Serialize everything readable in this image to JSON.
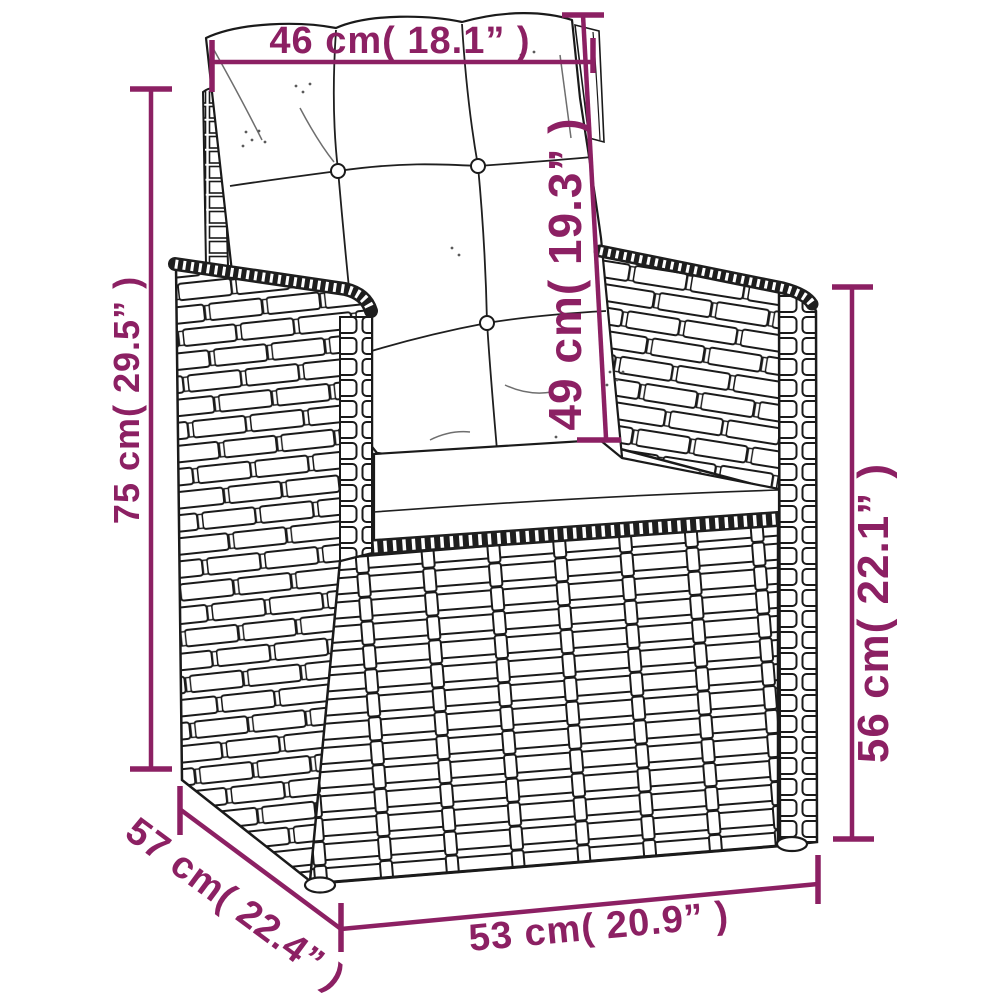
{
  "diagram": {
    "kind": "product-dimension-diagram",
    "subject": "rattan wicker armchair with back and seat cushions",
    "accent_color": "#8C2063",
    "line_color": "#1a1a1a",
    "background_color": "#ffffff"
  },
  "dimensions": {
    "top_width": {
      "label": "46 cm( 18.1” )",
      "cm": 46,
      "inches": 18.1,
      "measures": "back cushion width"
    },
    "back_height": {
      "label": "49 cm( 19.3” )",
      "cm": 49,
      "inches": 19.3,
      "measures": "back cushion height"
    },
    "total_height": {
      "label": "75 cm( 29.5” )",
      "cm": 75,
      "inches": 29.5,
      "measures": "overall height"
    },
    "arm_height": {
      "label": "56 cm( 22.1” )",
      "cm": 56,
      "inches": 22.1,
      "measures": "armrest height"
    },
    "depth": {
      "label": "57 cm( 22.4” )",
      "cm": 57,
      "inches": 22.4,
      "measures": "seat depth"
    },
    "front_width": {
      "label": "53 cm( 20.9” )",
      "cm": 53,
      "inches": 20.9,
      "measures": "front width"
    }
  }
}
